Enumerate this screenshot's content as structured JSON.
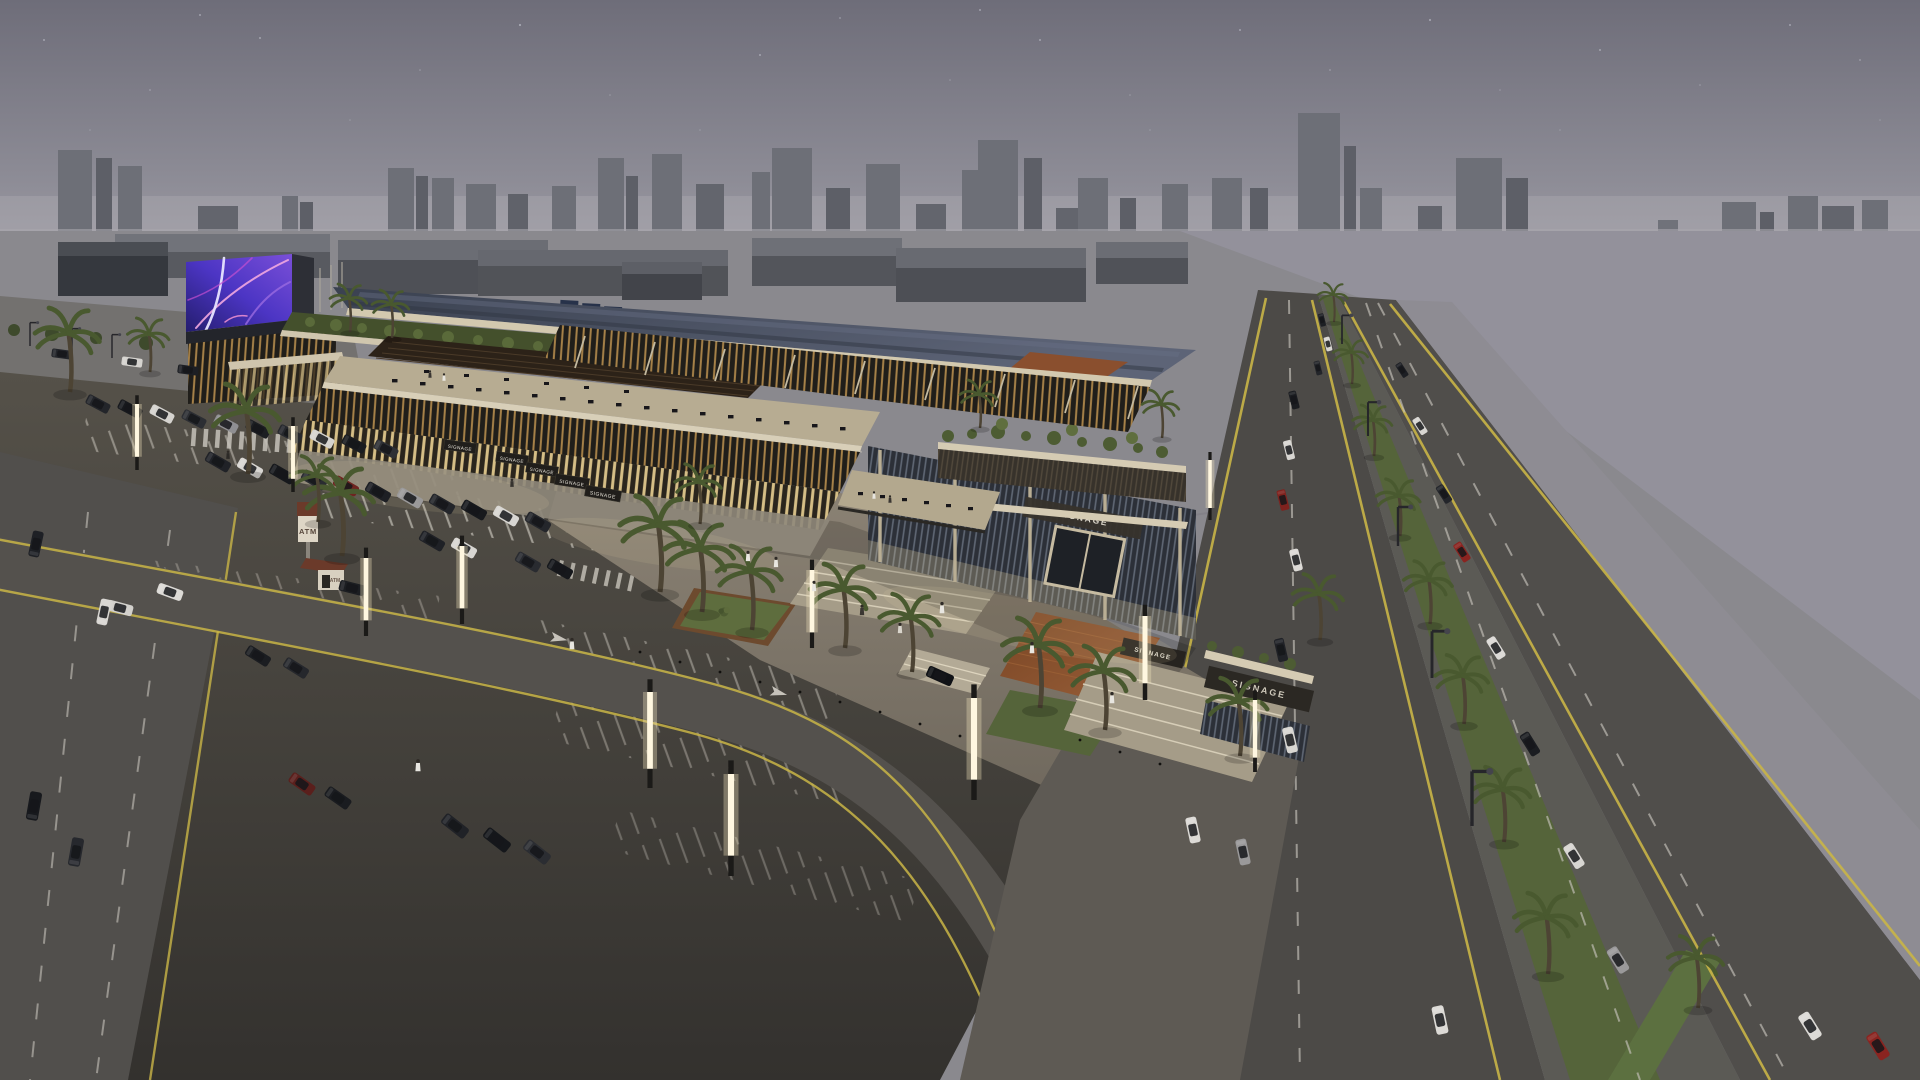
{
  "scene": {
    "title": "Aerial dusk rendering of a retail mall complex",
    "setting": "Mixed-use shopping center with rooftop terraces and gardens, LED billboard, surface parking lot with palm trees, palm-lined boulevard and gray massing-model city skyline at dusk"
  },
  "signage": {
    "main_facade": "SIGNAGE",
    "entry_canopy": "SIGNAGE",
    "right_pavilion": "SIGNAGE",
    "storefront_boards": [
      "SIGNAGE",
      "SIGNAGE",
      "SIGNAGE",
      "SIGNAGE",
      "SIGNAGE"
    ],
    "atm_pylon": "ATM",
    "atm_kiosk": "ATM"
  },
  "palette": {
    "sky_top": "#6e6d79",
    "sky_horizon": "#a7a5ac",
    "skyline_gray": "#6d6f77",
    "water_gray": "#93919b",
    "asphalt": "#46433f",
    "lane_yellow": "#c9b547",
    "marking_white": "#c6c2ba",
    "grass_green": "#55643a",
    "palm_frond": "#49592f",
    "facade_beige": "#d3c9af",
    "glass_warm": "#e8cf92",
    "roof_slate": "#454c5e",
    "canopy_brown": "#7a4524",
    "led_purple": "#4c35c4",
    "led_pink": "#f2a8e0"
  }
}
